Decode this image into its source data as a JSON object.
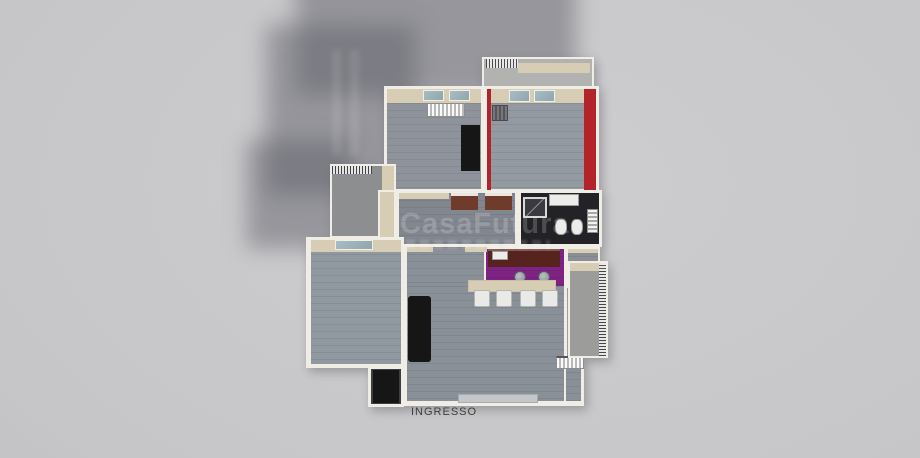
{
  "labels": {
    "entrance": "INGRESSO"
  },
  "watermark": {
    "brand": "CasaFutura"
  },
  "colors": {
    "background_light": "#cdcdcf",
    "background_dark": "#b7b7ba",
    "shadow": "rgba(97,97,107,0.50)",
    "wall_cream": "#d6cdb4",
    "wall_white": "#efede5",
    "floor_gray": "#8f949c",
    "floor_hall": "#82878f",
    "floor_bedroom_left": "#9098a0",
    "floor_living": "#8a9098",
    "floor_bath": "#232327",
    "floor_terrace": "#b2b2b0",
    "floor_balcony": "#9c9c9a",
    "accent_red": "#b2232a",
    "kitchen_purple": "#7e2383",
    "cabinet_maroon": "#56231f",
    "furniture_black": "#161616",
    "door_brown": "#6f3c2c",
    "glass_blue": "#a9bdc3",
    "chair_white": "#e9e9e7",
    "label_color": "#3d3d3d",
    "watermark_color": "rgba(245,245,245,0.20)"
  }
}
